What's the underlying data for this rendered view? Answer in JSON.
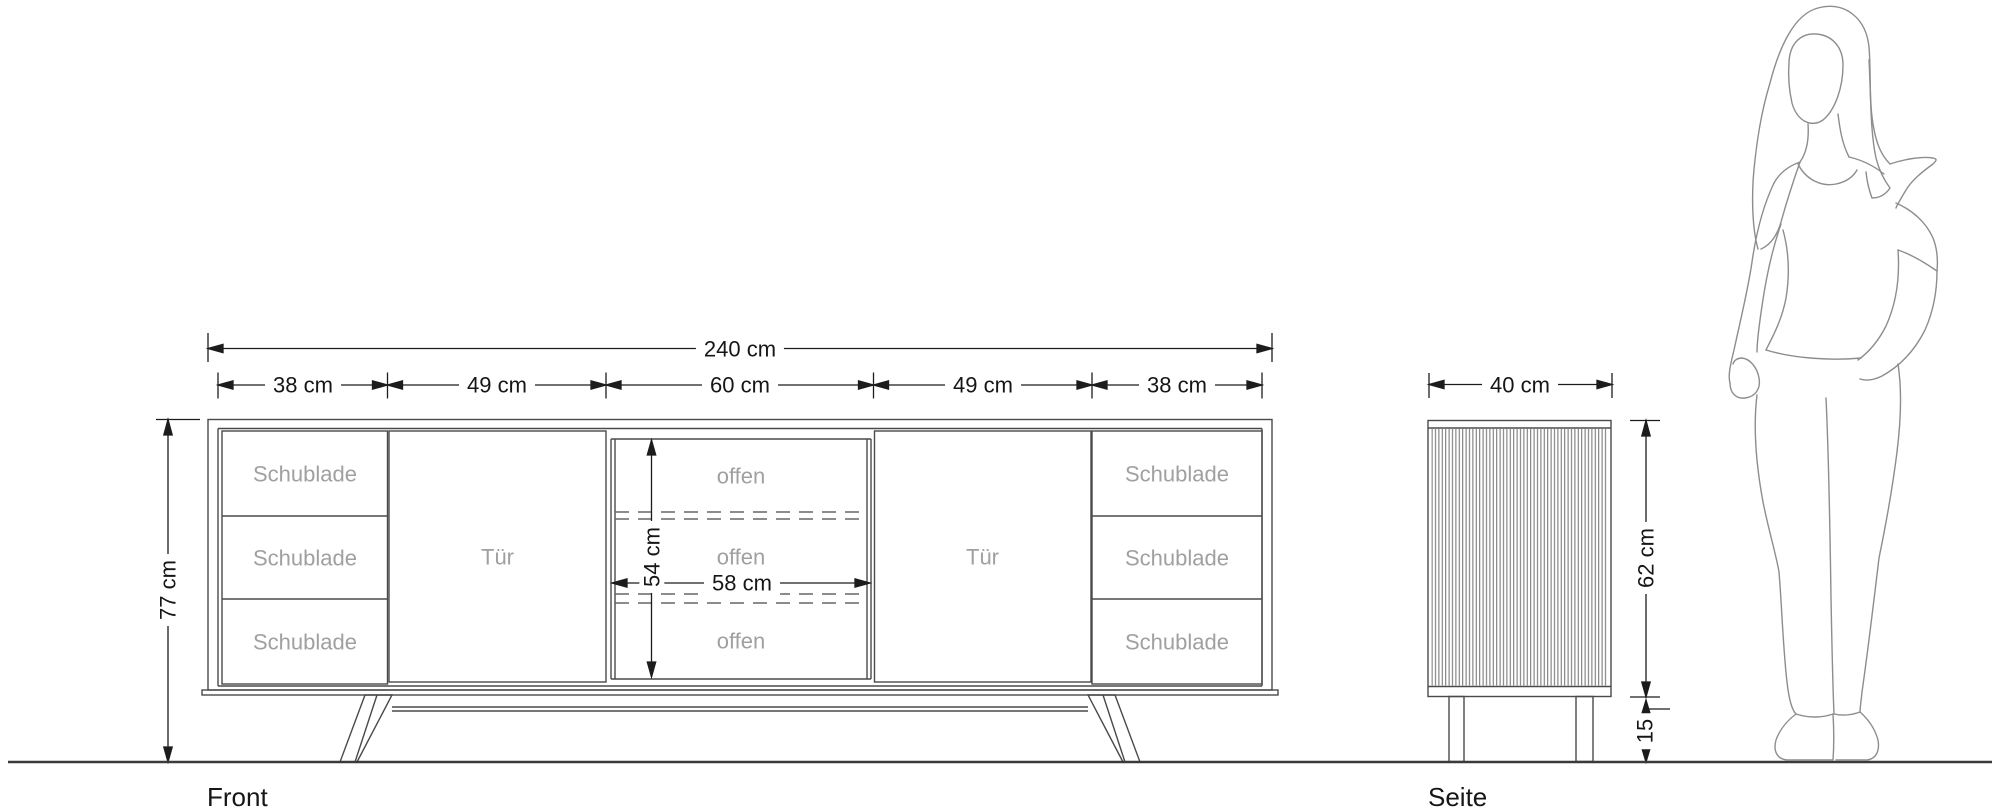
{
  "colors": {
    "cabinet_line": "#4a4a4a",
    "dimension_line": "#1c1c1c",
    "compartment_label": "#a0a0a0",
    "figure_line": "#8d8d8d",
    "ground_line": "#3a3a3a",
    "background": "#ffffff"
  },
  "front_view": {
    "caption": "Front",
    "dim_total_width": "240 cm",
    "dim_sections": [
      {
        "label": "38 cm"
      },
      {
        "label": "49 cm"
      },
      {
        "label": "60 cm"
      },
      {
        "label": "49 cm"
      },
      {
        "label": "38 cm"
      }
    ],
    "dim_height": "77 cm",
    "dim_open_height": "54 cm",
    "dim_open_width": "58 cm",
    "left_drawers": [
      {
        "label": "Schublade"
      },
      {
        "label": "Schublade"
      },
      {
        "label": "Schublade"
      }
    ],
    "left_door": {
      "label": "Tür"
    },
    "open_compartments": [
      {
        "label": "offen"
      },
      {
        "label": "offen"
      },
      {
        "label": "offen"
      }
    ],
    "right_door": {
      "label": "Tür"
    },
    "right_drawers": [
      {
        "label": "Schublade"
      },
      {
        "label": "Schublade"
      },
      {
        "label": "Schublade"
      }
    ]
  },
  "side_view": {
    "caption": "Seite",
    "dim_depth": "40 cm",
    "dim_body_height": "62 cm",
    "dim_leg_height": "15"
  }
}
